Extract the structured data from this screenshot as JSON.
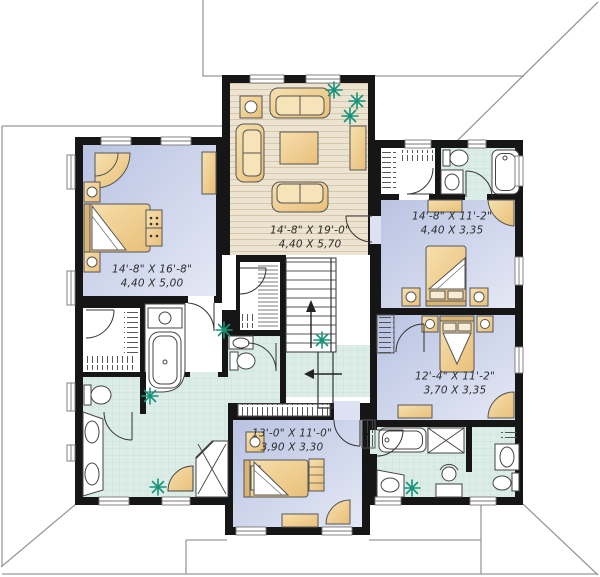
{
  "plan_type": "floor-plan",
  "rooms": [
    {
      "id": "master-bedroom",
      "dimensions_imperial": "14'-8\" X 16'-8\"",
      "dimensions_metric": "4,40 X 5,00"
    },
    {
      "id": "sitting-room",
      "dimensions_imperial": "14'-8\" X 19'-0\"",
      "dimensions_metric": "4,40 X 5,70"
    },
    {
      "id": "bedroom-2",
      "dimensions_imperial": "14'-8\" X 11'-2\"",
      "dimensions_metric": "4,40 X 3,35"
    },
    {
      "id": "bedroom-3",
      "dimensions_imperial": "12'-4\" X 11'-2\"",
      "dimensions_metric": "3,70 X 3,35"
    },
    {
      "id": "bedroom-4",
      "dimensions_imperial": "13'-0\" X 11'-0\"",
      "dimensions_metric": "3,90 X 3,30"
    }
  ],
  "colors": {
    "wall": "#161616",
    "bedroom_floor_light": "#e4e8f5",
    "bedroom_floor_dark": "#b9c3e2",
    "wood_floor": "#ece3d1",
    "tile_floor": "#dcede7",
    "furniture_tan": "#f0cf95",
    "plant_green": "#17947c",
    "roof_line": "#999999"
  },
  "fixtures": [
    "bed",
    "sofa",
    "coffee-table",
    "nightstand-lamp",
    "dresser",
    "corner-chair",
    "garden-tub",
    "bathtub",
    "corner-shower",
    "toilet",
    "vanity-sink",
    "pedestal-sink",
    "walk-in-closet",
    "linen-closet",
    "stairs",
    "plant"
  ]
}
